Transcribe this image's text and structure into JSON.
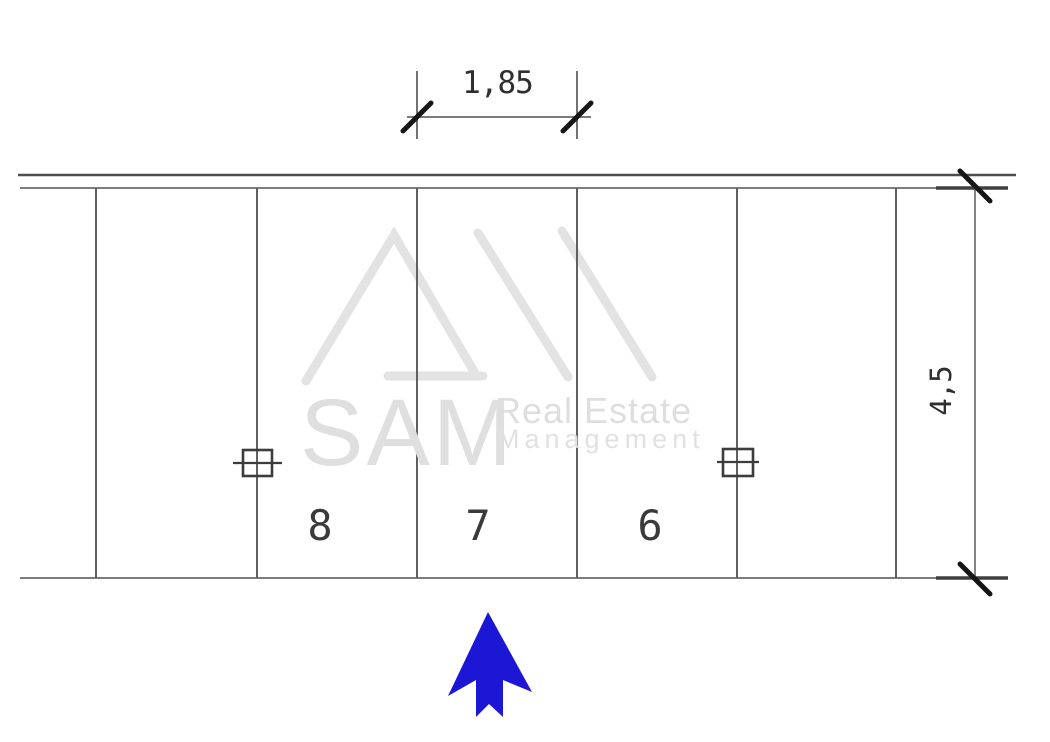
{
  "drawing": {
    "watermark": {
      "brand": "SAM",
      "tagline_top": "Real Estate",
      "tagline_bottom": "Management"
    },
    "dimension_labels": {
      "stall_width_m": "1,85",
      "stall_depth_m": "4,5"
    },
    "stall_labels": [
      "8",
      "7",
      "6"
    ],
    "colors": {
      "entry_arrow_blue": "#1b17d4",
      "watermark_gray": "#e3e3e3",
      "wall_line_dark": "#4d4d4d",
      "line_gray": "#7d7d7d",
      "stall_line_gray": "#606060",
      "tick_black": "#161616"
    }
  }
}
